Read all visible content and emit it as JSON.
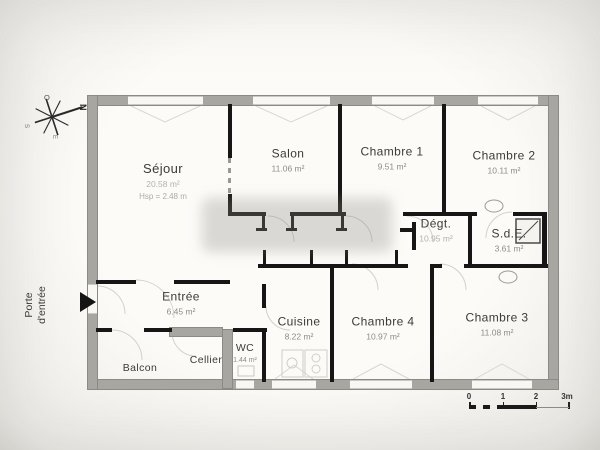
{
  "rooms": [
    {
      "name": "Séjour",
      "area": "20.58 m²",
      "hsp": "Hsp = 2.48 m"
    },
    {
      "name": "Salon",
      "area": "11.06 m²"
    },
    {
      "name": "Chambre 1",
      "area": "9.51 m²"
    },
    {
      "name": "Chambre 2",
      "area": "10.11 m²"
    },
    {
      "name": "Dégt.",
      "area": "10.95 m²"
    },
    {
      "name": "S.d.E.",
      "area": "3.61 m²"
    },
    {
      "name": "Entrée",
      "area": "6.45 m²"
    },
    {
      "name": "Cuisine",
      "area": "8.22 m²"
    },
    {
      "name": "Chambre 4",
      "area": "10.97 m²"
    },
    {
      "name": "Chambre 3",
      "area": "11.08 m²"
    },
    {
      "name": "WC",
      "area": "1.44 m²"
    },
    {
      "name": "Cellier",
      "area": ""
    },
    {
      "name": "Balcon",
      "area": ""
    }
  ],
  "entrance": {
    "line1": "Porte",
    "line2": "d'entrée"
  },
  "compass": {
    "north": "N",
    "south": "S",
    "east": "E",
    "west": "O"
  },
  "scale_bar": {
    "tick0": "0",
    "tick1": "1",
    "tick2": "2",
    "tick3": "3m"
  },
  "colors": {
    "exterior_wall": "#a7a6a1",
    "interior_wall": "#161616",
    "paper": "#fcfbf8",
    "faint_line": "#d6d5d1"
  }
}
